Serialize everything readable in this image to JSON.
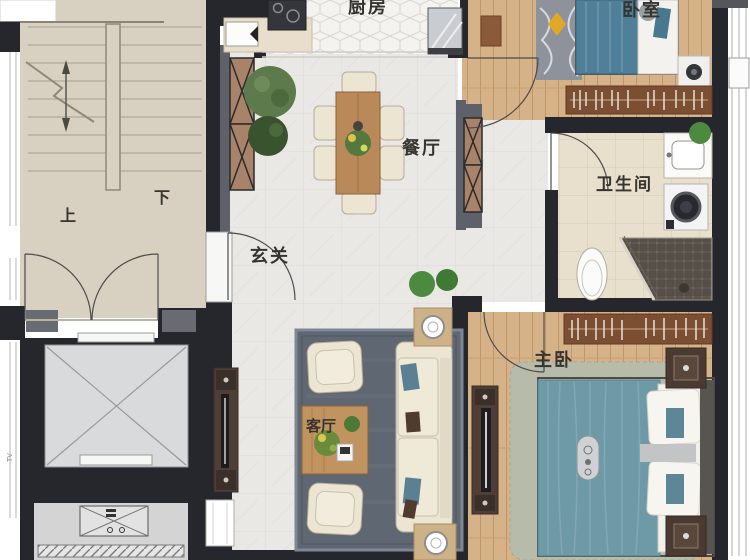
{
  "plan_title": "apartment-floor-plan",
  "rooms": {
    "kitchen": {
      "label": "厨房"
    },
    "bedroom": {
      "label": "卧室"
    },
    "dining": {
      "label": "餐厅"
    },
    "bathroom": {
      "label": "卫生间"
    },
    "entry": {
      "label": "玄关"
    },
    "master_bedroom": {
      "label": "主卧"
    },
    "living": {
      "label": "客厅"
    }
  },
  "stairs": {
    "up": "上",
    "down": "下"
  },
  "annotations": {
    "tv": "TV"
  },
  "palette": {
    "wall": "#26272d",
    "wall_gray": "#5e6169",
    "stair_floor": "#d8d0c0",
    "marble_floor": "#eae8e5",
    "wood_floor": "#d6b289",
    "hex_tile": "#f4f3f0",
    "bath_tile": "#e8dfcd",
    "elevator_gray": "#d9dadb",
    "rug_slate": "#5f6872",
    "rug_sage": "#b7bba9",
    "bedroom_rug_gray": "#8e929b",
    "bed_teal": "#4f7f99",
    "duvet_teal": "#6e9aa8",
    "cream": "#ece5d2",
    "cabinet_bronze": "#a8836a",
    "table_wood": "#b9895a",
    "wardrobe_brown": "#7c4f33",
    "plant_green": "#55783f",
    "accent_yellow": "#e0a826"
  }
}
